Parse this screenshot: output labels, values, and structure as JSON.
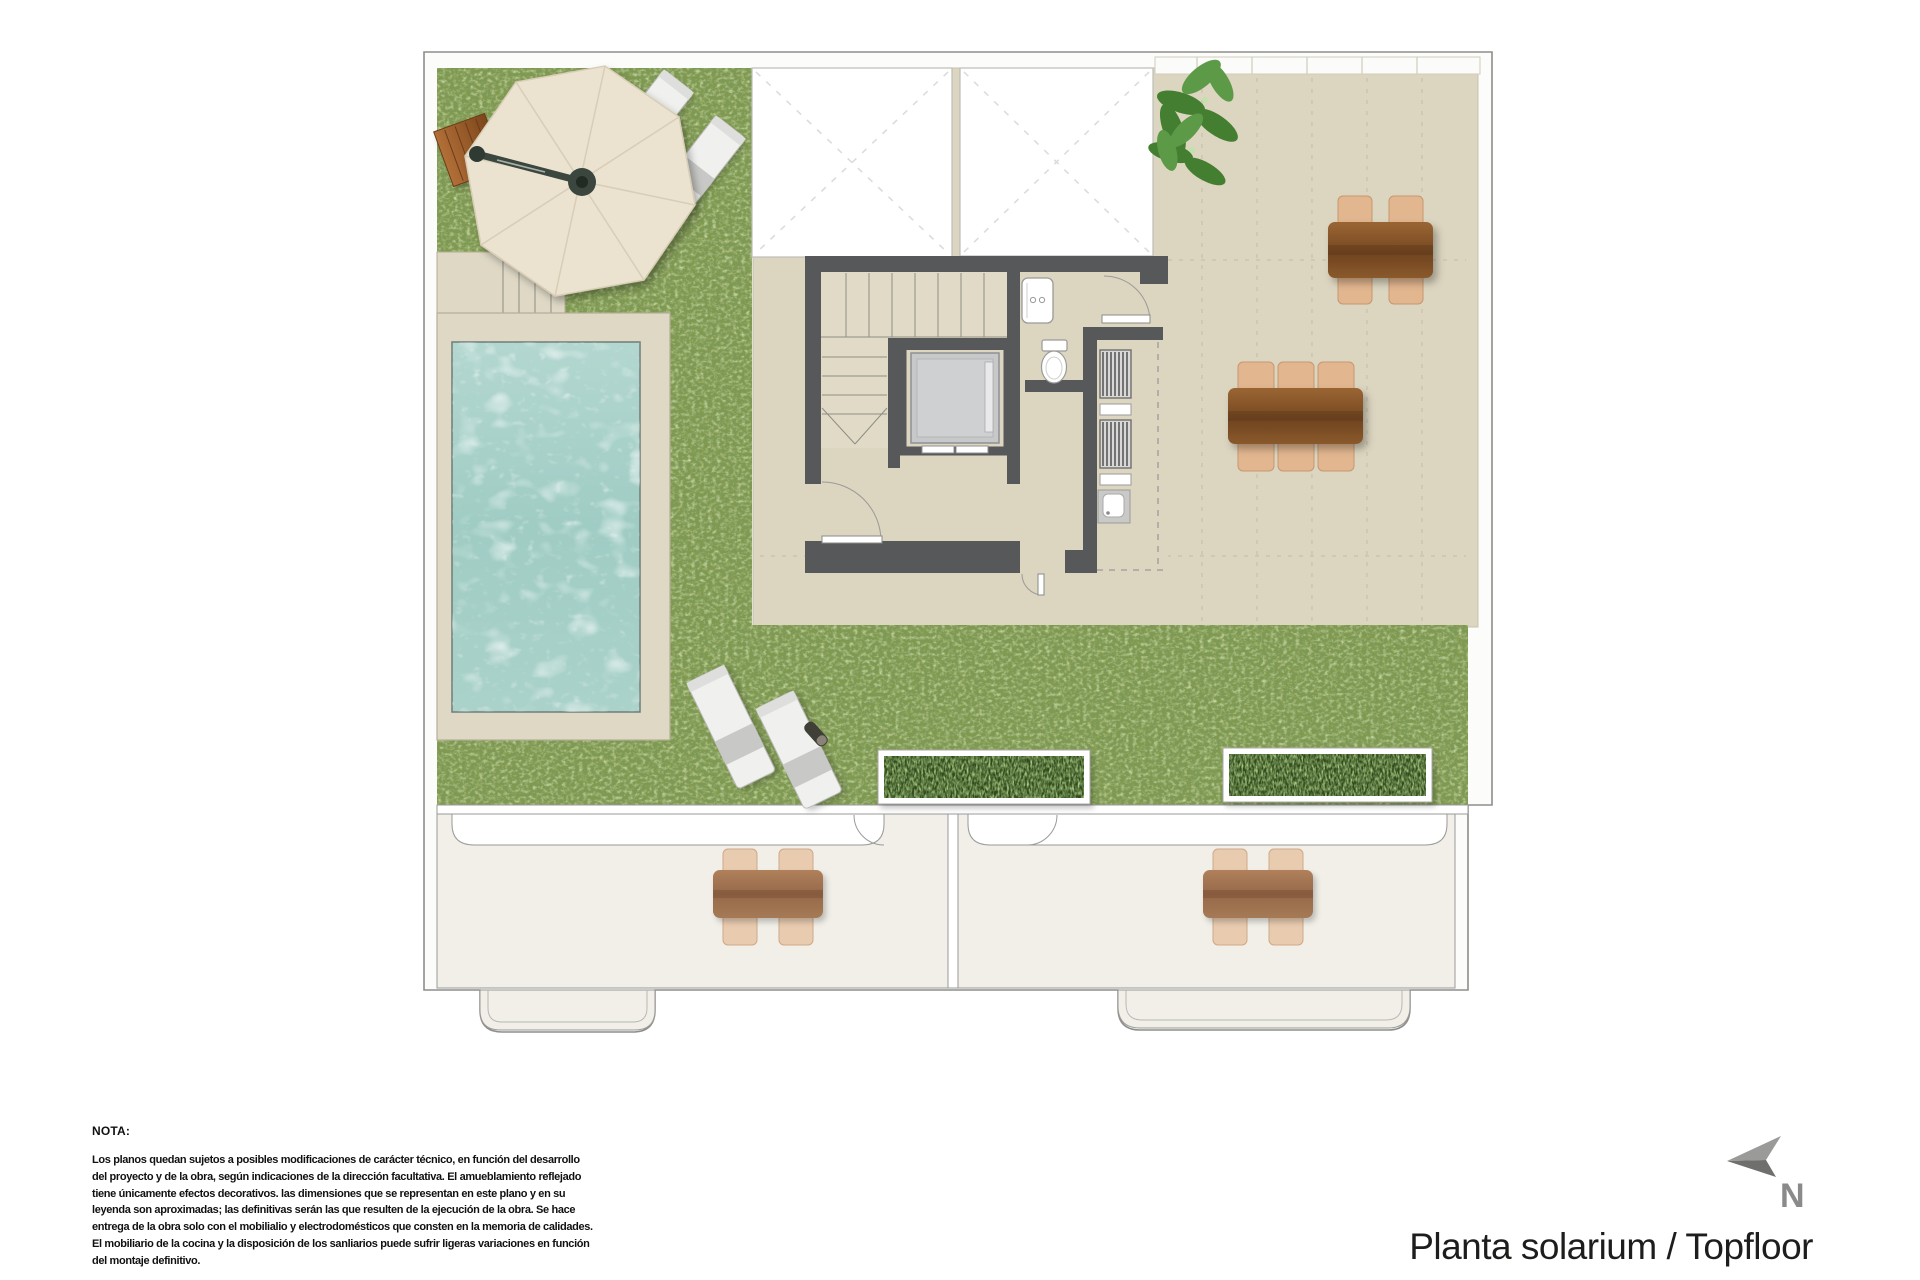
{
  "title": {
    "text": "Planta solarium / Topfloor"
  },
  "compass": {
    "label": "N"
  },
  "note": {
    "heading": "NOTA:",
    "lines": [
      "Los planos quedan sujetos a posibles modificaciones de carácter técnico, en función del desarrollo",
      "del proyecto y de la obra, según indicaciones de la dirección facultativa. El amueblamiento reflejado",
      "tiene únicamente efectos decorativos. las dimensiones que se representan en este plano y en su",
      "leyenda son aproximadas; las definitivas serán las que resulten de la ejecución de la obra. Se hace",
      "entrega de la obra solo con el mobilialio y electrodomésticos que consten en la memoria de calidades.",
      "El mobiliario de la cocina y la disposición de los sanliarios puede sufrir ligeras variaciones en función",
      "del montaje definitivo."
    ]
  },
  "colors": {
    "paper": "#ffffff",
    "outline": "#8d8d8b",
    "grass": "#80994f",
    "terrace": "#dcd5c0",
    "ivory": "#f1efe8",
    "wall": "#57585a",
    "deck": "#ded8c5",
    "water": "#a7d0c9",
    "wood": "#7e4f26",
    "wicker": "#e8c6a6",
    "lounger": "#f0f0ef",
    "planter": "#304a1d",
    "ink": "#1d1d1b",
    "gray": "#8a8a8a"
  }
}
